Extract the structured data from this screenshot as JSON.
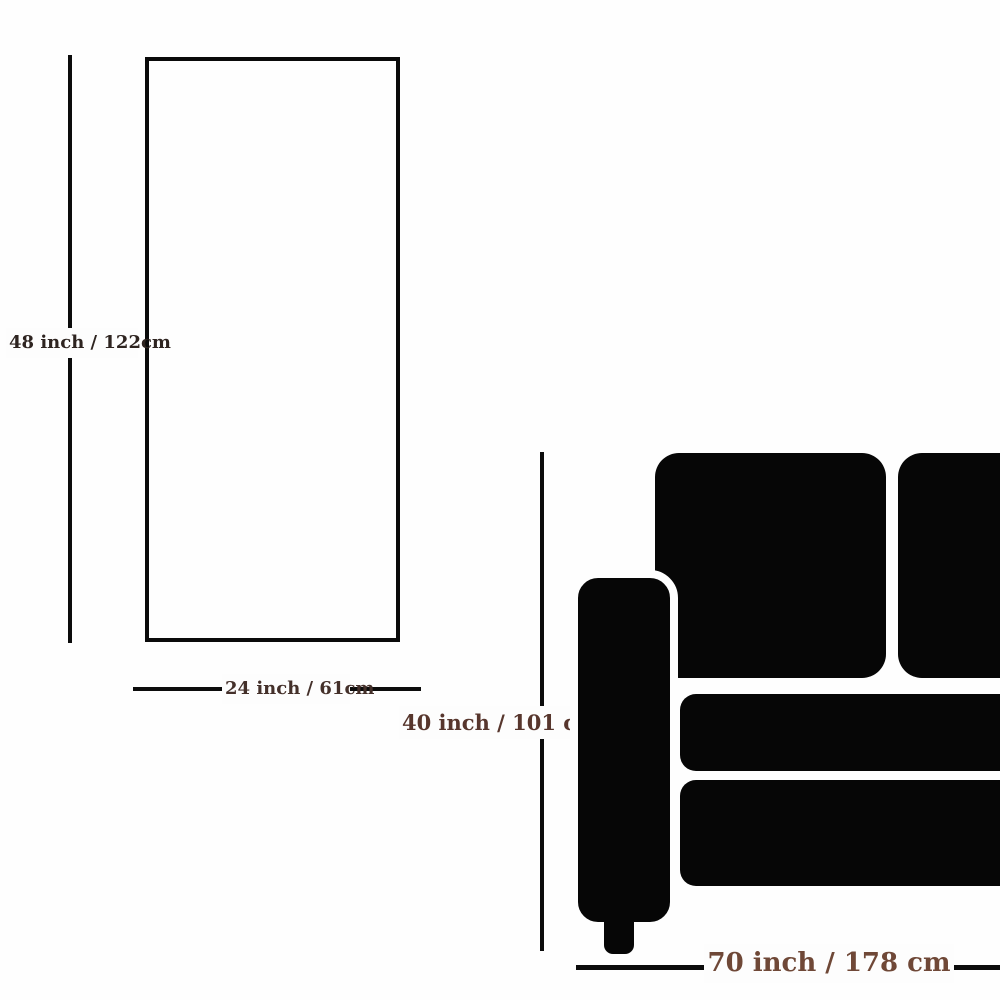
{
  "diagram": {
    "title": "wall-art-vs-sofa-size-comparison",
    "canvas_item": {
      "height_label": "48 inch / 122cm",
      "width_label": "24 inch / 61cm"
    },
    "sofa_item": {
      "height_label": "40 inch / 101 cm",
      "width_label": "70 inch / 178 cm"
    },
    "colors": {
      "background": "#fefefe",
      "outline_and_lines": "#0a0a0a",
      "sofa_silhouette": "#060606",
      "canvas_height_label_text": "#2e2420",
      "canvas_width_label_text": "#44302a",
      "sofa_height_label_text": "#57362d",
      "sofa_width_label_text": "#6f4837"
    }
  }
}
